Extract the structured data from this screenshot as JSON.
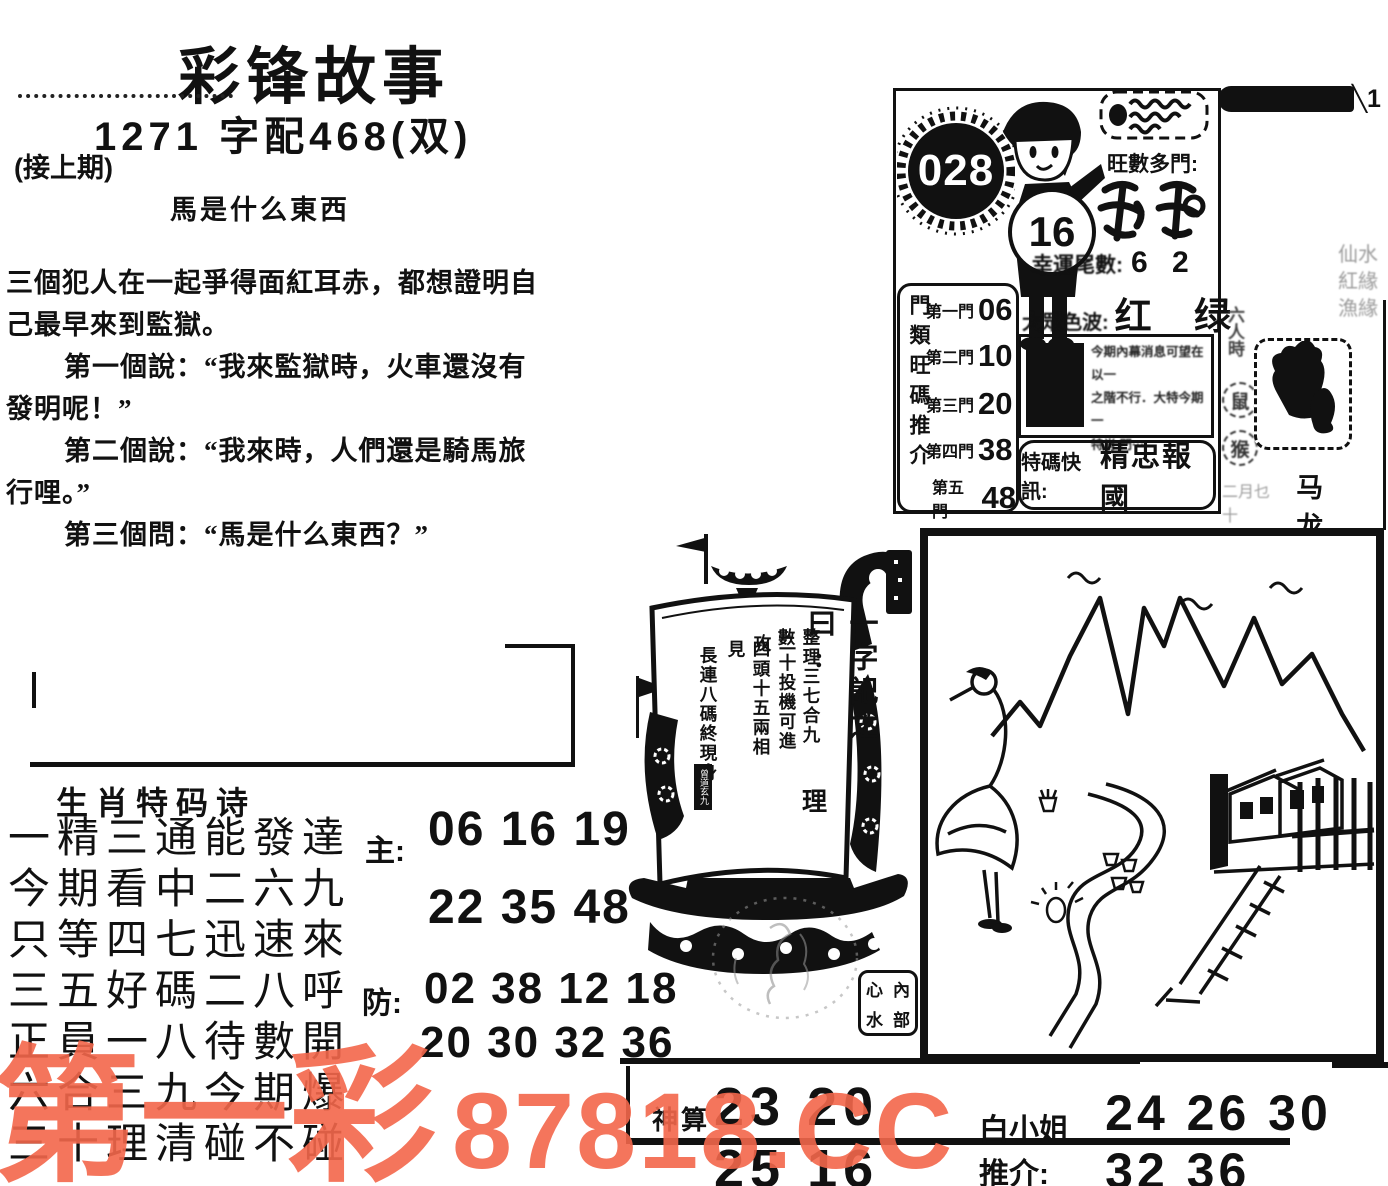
{
  "watermark": {
    "brand": "第一彩",
    "site": "87818.CC",
    "color": "#f3674b"
  },
  "header": {
    "title": "彩锋故事",
    "number_line": "1271 字配468(双)",
    "continued": "(接上期)",
    "story_subject": "馬是什么東西"
  },
  "story": {
    "lines": [
      "三個犯人在一起爭得面紅耳赤，都想證明自",
      "己最早來到監獄。",
      "第一個說：“我來監獄時，火車還沒有",
      "發明呢！”",
      "第二個說：“我來時，人們還是騎馬旅",
      "行哩。”",
      "第三個問：“馬是什么東西？”"
    ]
  },
  "poem": {
    "heading": "生肖特码诗",
    "lines": [
      "一精三通能發達",
      "今期看中二六九",
      "只等四七迅速來",
      "三五好碼二八呼",
      "正員一八待數開",
      "六合三九今期爆",
      "三十理清碰不碰"
    ],
    "main_label": "主:",
    "main_row1": "06 16 19",
    "main_row2": "22 35 48",
    "guard_label": "防:",
    "guard_row1": "02 38 12 18",
    "guard_row2": "20 30 32 36"
  },
  "panel": {
    "issue": "028",
    "belly": "16",
    "hot_label": "旺數多門:",
    "tail_label": "幸運尾數:",
    "tail_value": "6 2",
    "door_title": "門類旺碼推介",
    "doors": [
      {
        "label": "第一門",
        "value": "06"
      },
      {
        "label": "第二門",
        "value": "10"
      },
      {
        "label": "第三門",
        "value": "20"
      },
      {
        "label": "第四門",
        "value": "38"
      },
      {
        "label": "第五門",
        "value": "48"
      }
    ],
    "wave_label": "大眾色波:",
    "wave_value": "红 绿",
    "insider_lines": [
      "今期內幕消息可望在以一",
      "之階不行．大特今期一",
      "特肖 門···"
    ],
    "special_label": "特碼快訊:",
    "special_value": "精忠報國"
  },
  "strip": {
    "corner_mark": "╲1",
    "faint_rows": [
      "仙水",
      "紅緣",
      "漁緣"
    ],
    "side_label": "六人時",
    "zodiac1": "鼠",
    "zodiac2": "猴",
    "bottom_small": "二月乜十",
    "bottom_big": "马 龙"
  },
  "ship": {
    "motto_title": "一字記之曰:",
    "motto_char": "理",
    "columns": [
      "整理三七合九數",
      "二十投機可進攻",
      "四頭十五兩相見",
      "長連八碼終現身"
    ],
    "seal": "曾道玄九",
    "stamp": [
      "心",
      "內",
      "水",
      "部"
    ]
  },
  "bottom": {
    "algo_label": "神算",
    "left_numbers": "23 20 25 16",
    "tip_label": "白小姐推介:",
    "right_numbers": "24 26 30 32 36"
  }
}
